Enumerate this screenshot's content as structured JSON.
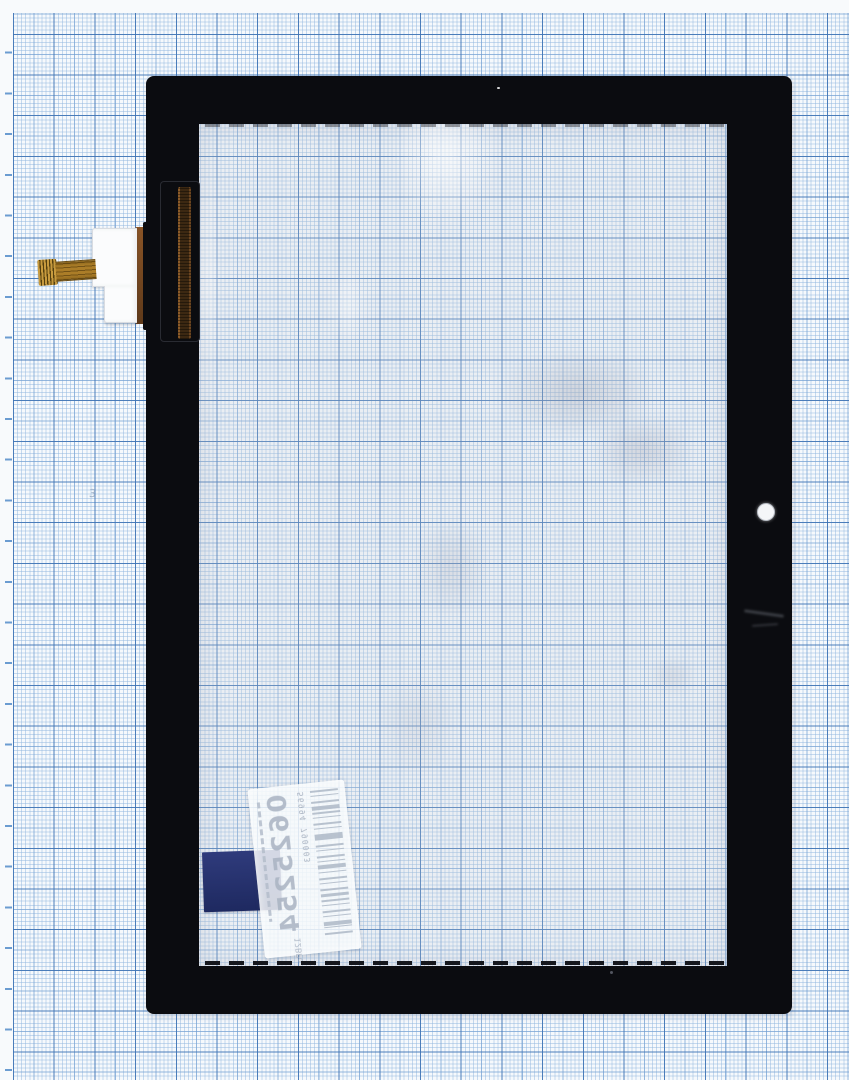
{
  "scene": {
    "type": "product-photo",
    "description": "Black tablet touchscreen digitizer glass with flex-cable connector lying face-down on blue millimeter graph paper",
    "paper": {
      "background": "#f6f9fc",
      "grid_fine_color": "#92b8de",
      "grid_medium_color": "#6d9bd0",
      "grid_bold_color": "#3e73b4",
      "handwritten_mark": "3"
    },
    "panel": {
      "bezel_color": "#0b0c10",
      "glass_tint": "rgba(197,204,216,0.24)"
    },
    "flex_assembly": {
      "connector_color": "#fbfcfd",
      "cable_color": "#ab7d28",
      "copper_strip_color": "#3c2812"
    },
    "barcode_label": {
      "big_digits": "0625254",
      "small_code": "12BPo",
      "barcode_digits": "56994 790003",
      "appearance": "mirrored, viewed through glass"
    },
    "blue_tab": {
      "color": "#27326f"
    }
  }
}
